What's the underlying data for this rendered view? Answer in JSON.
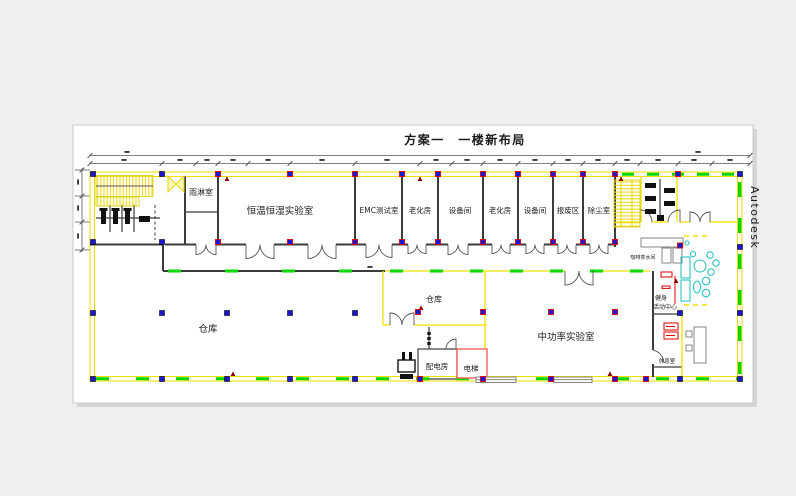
{
  "title": "方案一　一楼新布局",
  "watermark": "Autodesk",
  "rooms": {
    "rain_room": "雨淋室",
    "climate_lab": "恒温恒湿实验室",
    "emc_lab": "EMC测试室",
    "aging_room_1": "老化房",
    "equipment_room_1": "设备间",
    "aging_room_2": "老化房",
    "equipment_room_2": "设备间",
    "scrap_area": "报废区",
    "dust_room": "除尘室",
    "warehouse_main": "仓库",
    "warehouse_small": "仓库",
    "power_room": "配电房",
    "elevator": "电梯",
    "mid_power_lab": "中功率实验室",
    "coffee_room": "咖啡茶水间",
    "fitness_center": {
      "line1": "健身",
      "line2": "活动中心"
    },
    "rest_room": "休息室"
  },
  "colors": {
    "background_gray": "#efefef",
    "sheet_white": "#ffffff",
    "wall_yellow": "#f0e000",
    "wall_dark": "#3c3c3c",
    "dash_green": "#00d800",
    "column_blue": "#1a17d0",
    "column_red_outline": "#dd0000",
    "furniture_cyan": "#2cc4c4",
    "elevator_red": "#ff5050",
    "marker_dark_red": "#990000",
    "watermark_gray": "#9b9b9b"
  }
}
